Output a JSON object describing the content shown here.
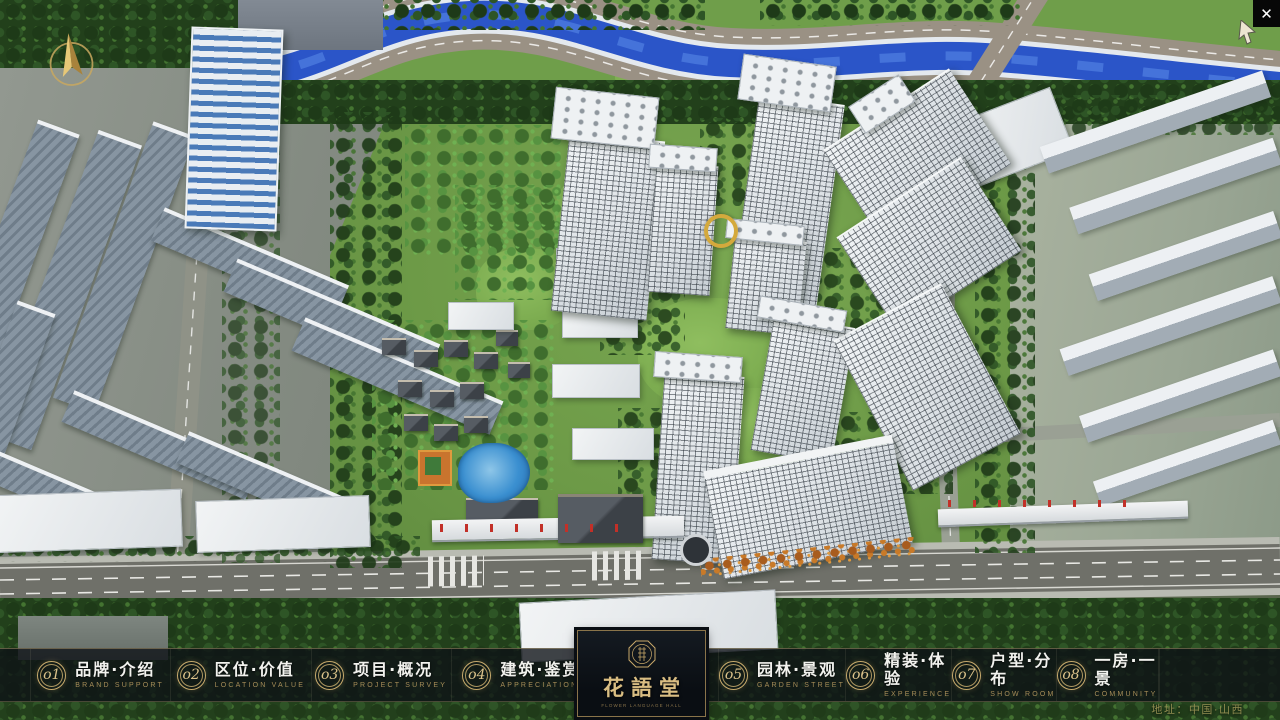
{
  "window": {
    "close_icon": "✕"
  },
  "nav": {
    "items": [
      {
        "num": "o1",
        "zh": "品牌·介绍",
        "en": "BRAND SUPPORT"
      },
      {
        "num": "o2",
        "zh": "区位·价值",
        "en": "LOCATION VALUE"
      },
      {
        "num": "o3",
        "zh": "项目·概况",
        "en": "PROJECT SURVEY"
      },
      {
        "num": "o4",
        "zh": "建筑·鉴赏",
        "en": "APPRECIATION"
      },
      {
        "num": "o5",
        "zh": "园林·景观",
        "en": "GARDEN STREET"
      },
      {
        "num": "o6",
        "zh": "精装·体验",
        "en": "EXPERIENCE"
      },
      {
        "num": "o7",
        "zh": "户型·分布",
        "en": "SHOW ROOM"
      },
      {
        "num": "o8",
        "zh": "一房·一景",
        "en": "COMMUNITY"
      }
    ]
  },
  "logo": {
    "zh": "花語堂",
    "en": "FLOWER LANGUAGE HALL"
  },
  "footer": {
    "address": "地址：中国·山西"
  },
  "colors": {
    "gold": "#c8ab6d",
    "bar_bg": "rgba(13,17,22,0.78)",
    "river": "#2b55c8"
  }
}
